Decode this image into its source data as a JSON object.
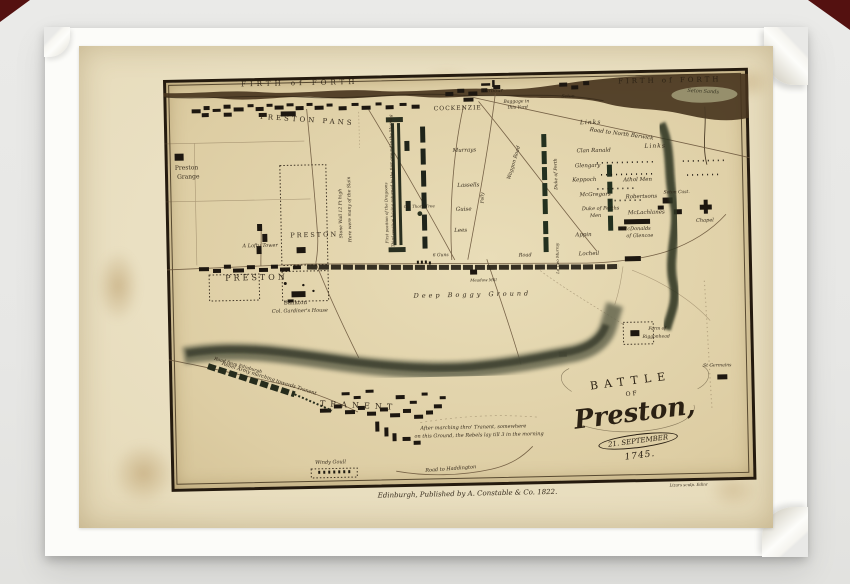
{
  "palette": {
    "background": "#e8e8e6",
    "card": "#fcfcf9",
    "sheet_paper": "#e7dcbc",
    "map_paper": "#ddcda3",
    "ink": "#2b2114",
    "corner_red": "#541110",
    "shore_dark": "#46331d"
  },
  "title": {
    "battle": "BATTLE",
    "of": "OF",
    "name": "Preston,",
    "date": "21. SEPTEMBER",
    "year": "1745."
  },
  "publisher_line": "Edinburgh, Published by A. Constable & Co. 1822.",
  "engraver_line": "Lizars sculp. Edinr",
  "labels": {
    "firth_left": "FIRTH of FORTH",
    "firth_right": "FIRTH of FORTH",
    "preston_pans": "PRESTON PANS",
    "harbour": "Harbour",
    "cockenzie": "COCKENZIE",
    "baggage1": "Baggage in",
    "baggage2": "this Yard",
    "seton": "Seton",
    "seton_sands": "Seton Sands",
    "links_upper": "Links",
    "links_lower": "Links",
    "road_north_berwick": "Road to North Berwick",
    "preston_grange1": "Preston",
    "preston_grange2": "Grange",
    "stone_wall": "Stone Wall 12 Ft high",
    "many_slain": "Here were many of the Slain",
    "preston_park": "PRESTON",
    "lofty_tower": "A Lofty Tower",
    "preston_town": "PRESTON",
    "bankton": "Bankton",
    "gardiners_house": "Col. Gardiner's House",
    "dragoons_first": "First position of the Dragoons",
    "dragoons_third": "Third position having returned to the first ground in the Morning",
    "murrays": "Murrays",
    "lassells": "Lassells",
    "guise": "Guise",
    "lees": "Lees",
    "old_thorn_tree": "Old Thorn Tree",
    "six_guns": "6 Guns",
    "folly": "Folly",
    "waggon_road": "Waggon Road",
    "duke_of_perth": "Duke of Perth",
    "clan_ranald": "Clan Ranald",
    "glengary": "Glengary",
    "keppoch": "Keppoch",
    "mcgregors": "McGregors",
    "duke_perths_men1": "Duke of Perths",
    "duke_perths_men2": "Men",
    "appin": "Appin",
    "locheil": "Locheil",
    "ld_geo_murray": "Ld Geo Murray",
    "athol_men": "Athol Men",
    "robertsons": "Robertsons",
    "mclachlanes": "McLachlanes",
    "mcdonalds1": "McDonalds",
    "mcdonalds2": "of Glencoe",
    "seton_castle": "Seton Cast.",
    "chapel": "Chapel",
    "road": "Road",
    "meadow_mill": "Meadow Mill",
    "deep_boggy_ground": "Deep Boggy Ground",
    "riggonhead1": "Farm of",
    "riggonhead2": "Riggonhead",
    "st_germains": "St Germains",
    "road_from_edinburgh": "Road from Edinburgh",
    "rebel_army": "Rebel Army marching towards Tranent",
    "tranent": "TRANENT",
    "night_note1": "After marching thro' Tranent, somewhere",
    "night_note2": "on this Ground, the Rebels lay till 3 in the morning",
    "windy_goull": "Windy Goull",
    "road_to_haddington": "Road to Haddington"
  }
}
